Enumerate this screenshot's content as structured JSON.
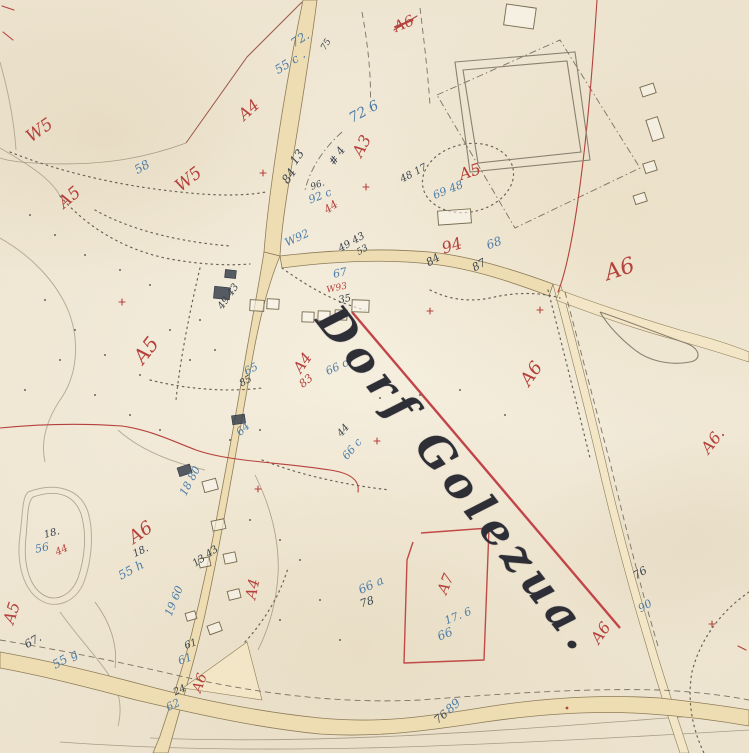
{
  "map": {
    "village_name": "Dorf Golezua.",
    "village_name_struck": true,
    "colors": {
      "paper": "#f0e7d4",
      "road_fill": "#eeddb2",
      "line_brown": "#8d7c58",
      "pencil": "#b7ac97",
      "red_ink": "#b5413c",
      "blue_ink": "#4d7da8",
      "dark_ink": "#3b4450",
      "village_ink": "#2e2e36"
    },
    "annotations": [
      {
        "text": "W5",
        "x": 40,
        "y": 131,
        "rot": -35,
        "color": "red",
        "size": 17
      },
      {
        "text": "A4",
        "x": 249,
        "y": 110,
        "rot": -42,
        "color": "red",
        "size": 16
      },
      {
        "text": "W5",
        "x": 189,
        "y": 180,
        "rot": -38,
        "color": "red",
        "size": 17
      },
      {
        "text": "A5",
        "x": 70,
        "y": 198,
        "rot": -40,
        "color": "red",
        "size": 17
      },
      {
        "text": "A6",
        "x": 404,
        "y": 24,
        "rot": -22,
        "color": "red",
        "size": 15,
        "struck": true
      },
      {
        "text": "A3",
        "x": 362,
        "y": 146,
        "rot": -62,
        "color": "red",
        "size": 16
      },
      {
        "text": "A5",
        "x": 470,
        "y": 172,
        "rot": -18,
        "color": "red",
        "size": 16
      },
      {
        "text": "A6",
        "x": 620,
        "y": 270,
        "rot": -18,
        "color": "red",
        "size": 22
      },
      {
        "text": "A6",
        "x": 532,
        "y": 374,
        "rot": -55,
        "color": "red",
        "size": 18
      },
      {
        "text": "A5",
        "x": 146,
        "y": 350,
        "rot": -52,
        "color": "red",
        "size": 20
      },
      {
        "text": "A4",
        "x": 303,
        "y": 363,
        "rot": -55,
        "color": "red",
        "size": 15
      },
      {
        "text": "83",
        "x": 306,
        "y": 381,
        "rot": -40,
        "color": "red",
        "size": 11
      },
      {
        "text": "44",
        "x": 331,
        "y": 207,
        "rot": -35,
        "color": "red",
        "size": 11
      },
      {
        "text": "94",
        "x": 452,
        "y": 246,
        "rot": -18,
        "color": "red",
        "size": 16
      },
      {
        "text": "A6.",
        "x": 713,
        "y": 441,
        "rot": -52,
        "color": "red",
        "size": 16
      },
      {
        "text": "A6",
        "x": 141,
        "y": 533,
        "rot": -35,
        "color": "red",
        "size": 18
      },
      {
        "text": "A5",
        "x": 12,
        "y": 613,
        "rot": -72,
        "color": "red",
        "size": 16
      },
      {
        "text": "A4",
        "x": 253,
        "y": 589,
        "rot": -78,
        "color": "red",
        "size": 15
      },
      {
        "text": "A7",
        "x": 446,
        "y": 584,
        "rot": -68,
        "color": "red",
        "size": 15
      },
      {
        "text": "A6",
        "x": 601,
        "y": 633,
        "rot": -55,
        "color": "red",
        "size": 16
      },
      {
        "text": "A6",
        "x": 200,
        "y": 683,
        "rot": -70,
        "color": "red",
        "size": 14
      },
      {
        "text": "W93",
        "x": 337,
        "y": 289,
        "rot": -12,
        "color": "red",
        "size": 9
      },
      {
        "text": "44",
        "x": 62,
        "y": 551,
        "rot": -25,
        "color": "red",
        "size": 10
      },
      {
        "text": "58",
        "x": 142,
        "y": 167,
        "rot": -30,
        "color": "blue",
        "size": 12
      },
      {
        "text": "72.",
        "x": 300,
        "y": 39,
        "rot": -32,
        "color": "blue",
        "size": 12
      },
      {
        "text": "55 c .",
        "x": 290,
        "y": 62,
        "rot": -32,
        "color": "blue",
        "size": 12
      },
      {
        "text": "72 6",
        "x": 364,
        "y": 112,
        "rot": -28,
        "color": "blue",
        "size": 14
      },
      {
        "text": "92 c",
        "x": 320,
        "y": 196,
        "rot": -22,
        "color": "blue",
        "size": 11
      },
      {
        "text": "W92",
        "x": 297,
        "y": 238,
        "rot": -25,
        "color": "blue",
        "size": 11
      },
      {
        "text": "69 48",
        "x": 448,
        "y": 190,
        "rot": -22,
        "color": "blue",
        "size": 11
      },
      {
        "text": "68",
        "x": 494,
        "y": 243,
        "rot": -20,
        "color": "blue",
        "size": 12
      },
      {
        "text": "67",
        "x": 340,
        "y": 273,
        "rot": -12,
        "color": "blue",
        "size": 11
      },
      {
        "text": "65",
        "x": 251,
        "y": 369,
        "rot": -28,
        "color": "blue",
        "size": 11
      },
      {
        "text": "66 c",
        "x": 337,
        "y": 367,
        "rot": -25,
        "color": "blue",
        "size": 11
      },
      {
        "text": "66 a",
        "x": 371,
        "y": 585,
        "rot": -25,
        "color": "blue",
        "size": 12
      },
      {
        "text": "17. 6",
        "x": 458,
        "y": 616,
        "rot": -22,
        "color": "blue",
        "size": 11
      },
      {
        "text": "66",
        "x": 445,
        "y": 634,
        "rot": -22,
        "color": "blue",
        "size": 12
      },
      {
        "text": "89",
        "x": 453,
        "y": 706,
        "rot": -42,
        "color": "blue",
        "size": 12
      },
      {
        "text": "90",
        "x": 645,
        "y": 606,
        "rot": -30,
        "color": "blue",
        "size": 11
      },
      {
        "text": "56",
        "x": 42,
        "y": 548,
        "rot": -12,
        "color": "blue",
        "size": 11
      },
      {
        "text": "55 h",
        "x": 131,
        "y": 570,
        "rot": -28,
        "color": "blue",
        "size": 12
      },
      {
        "text": "55 g",
        "x": 65,
        "y": 659,
        "rot": -30,
        "color": "blue",
        "size": 12
      },
      {
        "text": "19 60",
        "x": 174,
        "y": 601,
        "rot": -68,
        "color": "blue",
        "size": 11
      },
      {
        "text": "64",
        "x": 243,
        "y": 429,
        "rot": -45,
        "color": "blue",
        "size": 11
      },
      {
        "text": "18 80",
        "x": 190,
        "y": 481,
        "rot": -62,
        "color": "blue",
        "size": 11
      },
      {
        "text": "62",
        "x": 173,
        "y": 705,
        "rot": -25,
        "color": "blue",
        "size": 11
      },
      {
        "text": "61",
        "x": 185,
        "y": 659,
        "rot": -20,
        "color": "blue",
        "size": 11
      },
      {
        "text": "66 c",
        "x": 352,
        "y": 449,
        "rot": -50,
        "color": "blue",
        "size": 11
      },
      {
        "text": "84",
        "x": 289,
        "y": 176,
        "rot": -55,
        "color": "dark",
        "size": 12
      },
      {
        "text": "# 4",
        "x": 337,
        "y": 156,
        "rot": -55,
        "color": "dark",
        "size": 11
      },
      {
        "text": "13",
        "x": 297,
        "y": 157,
        "rot": -55,
        "color": "dark",
        "size": 12
      },
      {
        "text": "96.",
        "x": 318,
        "y": 186,
        "rot": -20,
        "color": "dark",
        "size": 9
      },
      {
        "text": "48 17",
        "x": 414,
        "y": 174,
        "rot": -28,
        "color": "dark",
        "size": 10
      },
      {
        "text": "84",
        "x": 433,
        "y": 260,
        "rot": -30,
        "color": "dark",
        "size": 11
      },
      {
        "text": "87",
        "x": 479,
        "y": 265,
        "rot": -30,
        "color": "dark",
        "size": 11
      },
      {
        "text": "49 43",
        "x": 352,
        "y": 243,
        "rot": -30,
        "color": "dark",
        "size": 10
      },
      {
        "text": "49 43",
        "x": 229,
        "y": 297,
        "rot": -55,
        "color": "dark",
        "size": 10
      },
      {
        "text": "85",
        "x": 246,
        "y": 382,
        "rot": -28,
        "color": "dark",
        "size": 10
      },
      {
        "text": "78",
        "x": 367,
        "y": 602,
        "rot": -18,
        "color": "dark",
        "size": 11
      },
      {
        "text": "76",
        "x": 441,
        "y": 717,
        "rot": -40,
        "color": "dark",
        "size": 11
      },
      {
        "text": "76",
        "x": 640,
        "y": 573,
        "rot": -30,
        "color": "dark",
        "size": 11
      },
      {
        "text": "18.",
        "x": 52,
        "y": 534,
        "rot": -15,
        "color": "dark",
        "size": 10
      },
      {
        "text": "18.",
        "x": 141,
        "y": 552,
        "rot": -25,
        "color": "dark",
        "size": 10
      },
      {
        "text": "67.",
        "x": 33,
        "y": 641,
        "rot": -30,
        "color": "dark",
        "size": 11
      },
      {
        "text": "13 43",
        "x": 206,
        "y": 557,
        "rot": -35,
        "color": "dark",
        "size": 10
      },
      {
        "text": "61",
        "x": 191,
        "y": 645,
        "rot": -20,
        "color": "dark",
        "size": 10
      },
      {
        "text": "24",
        "x": 180,
        "y": 691,
        "rot": -25,
        "color": "dark",
        "size": 10
      },
      {
        "text": "44",
        "x": 344,
        "y": 431,
        "rot": -50,
        "color": "dark",
        "size": 10
      },
      {
        "text": "75",
        "x": 327,
        "y": 45,
        "rot": -60,
        "color": "dark",
        "size": 9
      },
      {
        "text": "35",
        "x": 345,
        "y": 300,
        "rot": -12,
        "color": "dark",
        "size": 10
      },
      {
        "text": "53",
        "x": 363,
        "y": 251,
        "rot": -30,
        "color": "dark",
        "size": 9
      }
    ]
  }
}
